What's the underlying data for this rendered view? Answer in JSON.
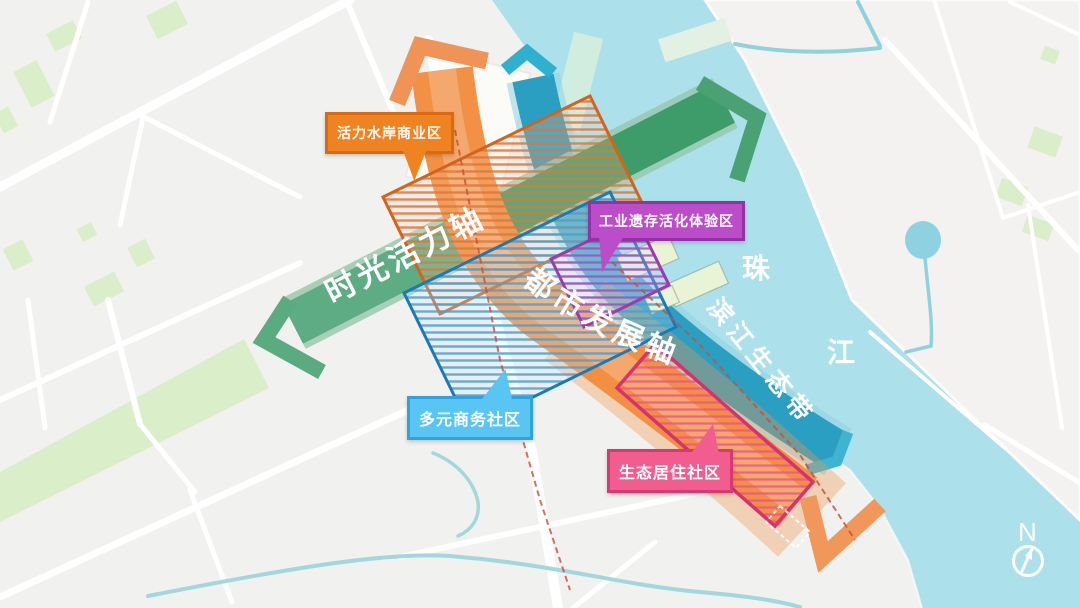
{
  "map": {
    "callouts": {
      "commercial": {
        "label": "活力水岸商业区",
        "fill": "#f08321",
        "border": "#db6a0e"
      },
      "industrial": {
        "label": "工业遗存活化体验区",
        "fill": "#bb4ec8",
        "border": "#9232a6"
      },
      "business": {
        "label": "多元商务社区",
        "fill": "#58c5f3",
        "border": "#2fa3dd"
      },
      "residential": {
        "label": "生态居住社区",
        "fill": "#f25d90",
        "border": "#d63a72"
      }
    },
    "axes": {
      "time_vitality": {
        "label": "时光活力轴",
        "color": "#3f9d6b"
      },
      "urban_dev": {
        "label": "都市发展轴",
        "color": "#f18c3e"
      },
      "riverside_eco": {
        "label": "滨江生态带",
        "color": "#2b9fc2"
      }
    },
    "river": {
      "name": "珠江",
      "char_top": "珠",
      "char_bottom": "江",
      "water_color": "#ace0eb"
    },
    "compass": {
      "label": "N"
    }
  }
}
